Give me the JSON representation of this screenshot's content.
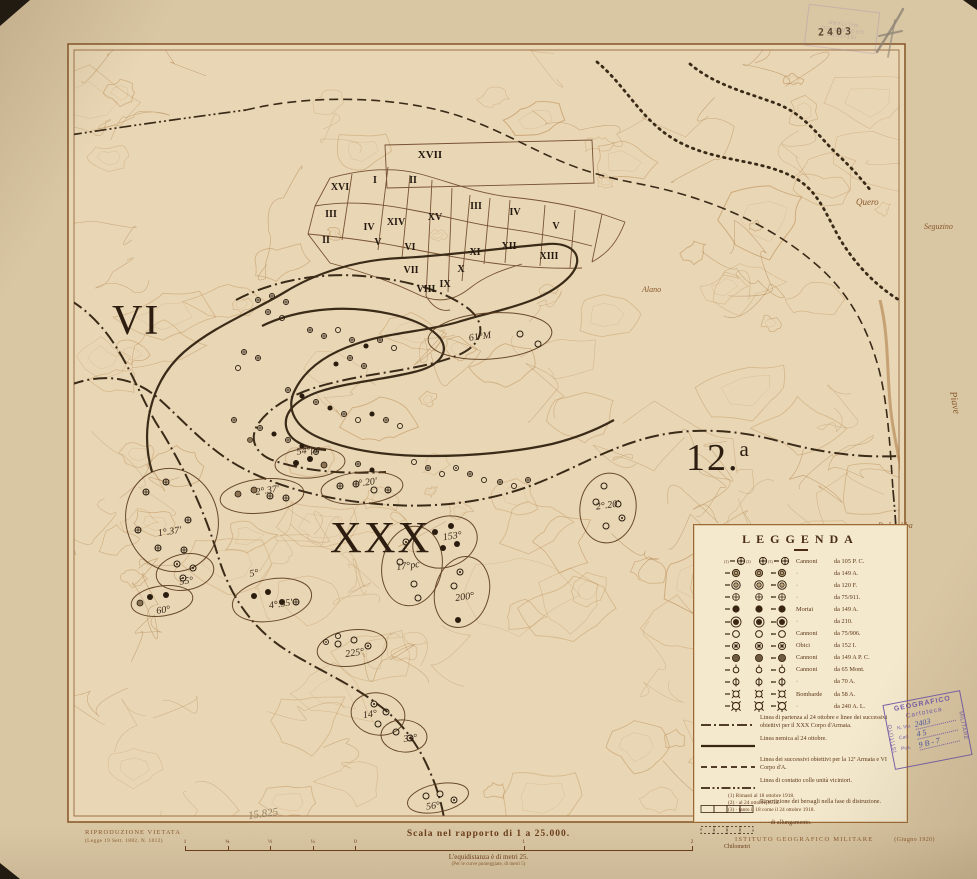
{
  "colors": {
    "paper": "#d9c6a3",
    "map_paper": "#e8d6b4",
    "legend_paper": "#f4e9cd",
    "contour": "#bc8a52",
    "ink": "#8a5a2e",
    "ink_dark": "#3a2a18",
    "symbol_ink": "#2a1d10",
    "stamp_purple": "#6d55a8",
    "handwriting_blue": "#3a49a6",
    "pencil": "#8a8274"
  },
  "legend": {
    "title": "LEGGENDA",
    "symbol_rows": [
      {
        "type": "cross105",
        "numbered": true,
        "name": "Cannoni",
        "cal": "da 105 P. C."
      },
      {
        "type": "shaded",
        "name": "·",
        "cal": "da 149 A."
      },
      {
        "type": "double",
        "name": "·",
        "cal": "da 120 F."
      },
      {
        "type": "plus",
        "name": "·",
        "cal": "da 75/911."
      },
      {
        "type": "filled",
        "name": "Mortai",
        "cal": "da 149 A."
      },
      {
        "type": "filledring",
        "name": "·",
        "cal": "da 210."
      },
      {
        "type": "open",
        "name": "Cannoni",
        "cal": "da 75/906."
      },
      {
        "type": "star",
        "name": "Obici",
        "cal": "da 152 I."
      },
      {
        "type": "gray",
        "name": "Cannoni",
        "cal": "da 149 A P. C."
      },
      {
        "type": "mont",
        "name": "Cannoni",
        "cal": "da 65 Mont."
      },
      {
        "type": "bar",
        "name": "·",
        "cal": "da 70 A."
      },
      {
        "type": "bomb",
        "name": "Bombarde",
        "cal": "da 58 A."
      },
      {
        "type": "bomblg",
        "name": "·",
        "cal": "da 240 A. L."
      }
    ],
    "line_rows": [
      {
        "style": "dashdot",
        "text": "Linea di partenza al 24 ottobre e linee dei successivi obiettivi per il XXX Corpo d'Armata."
      },
      {
        "style": "solid",
        "text": "Linea nemica al 24 ottobre."
      },
      {
        "style": "dashed",
        "text": "Linea dei successivi obiettivi per la 12ª Armata e VI Corpo d'A."
      },
      {
        "style": "contact",
        "text": "Linea di contatto colle unità viciniori."
      },
      {
        "style": "rects",
        "text": "Ripartizione dei bersagli nella fase di distruzione."
      },
      {
        "style": "rectsdot",
        "text": "·      ·      ·      di allungamento."
      }
    ],
    "footnotes": [
      "(1)  Rimasti al 18 ottobre 1918.",
      "(2)    ·    al 24 ottobre 1918.",
      "(3)    ·    tanto il 18 come il 24 ottobre 1918."
    ]
  },
  "margin": {
    "riprod_line1": "RIPRODUZIONE VIETATA",
    "riprod_line2": "(Legge 19 Sett. 1882, N. 1012)",
    "scale_title": "Scala nel rapporto di 1 a 25.000.",
    "equidistanza": "L'equidistanza è di metri 25.",
    "equidistanza_sub": "(Per le curve punteggiate, di metri 5)",
    "igm": "ISTITUTO GEOGRAFICO MILITARE",
    "igm_date": "(Giugno 1920)",
    "pencil_note": "15.825"
  },
  "scale_bar": {
    "unit_label": "Chilometri",
    "ticks": [
      {
        "p": 0.0,
        "label": "1"
      },
      {
        "p": 0.084,
        "label": "¾"
      },
      {
        "p": 0.168,
        "label": "½"
      },
      {
        "p": 0.252,
        "label": "¼"
      },
      {
        "p": 0.336,
        "label": "0"
      },
      {
        "p": 0.668,
        "label": "1"
      },
      {
        "p": 1.0,
        "label": "2"
      }
    ]
  },
  "stamps": {
    "cartoteca": {
      "top": "GEOGRAFICO",
      "left": "ISTITUTO",
      "right": "MILITARE",
      "center": "Cartoteca",
      "rows": [
        {
          "label": "N. Inv.",
          "value": "2403"
        },
        {
          "label": "Cas.",
          "value": "4 5"
        },
        {
          "label": "Pos.",
          "value": "9 B - 7"
        }
      ]
    },
    "top_faint": {
      "line1": "ISTITUTO",
      "line2": "GEOGRAFICO",
      "line3": "MILITARE"
    },
    "inventory_number": "2403"
  },
  "map": {
    "corps_labels": [
      {
        "text": "VI",
        "x": 112,
        "y": 334,
        "size": 42
      },
      {
        "text": "XXX",
        "x": 330,
        "y": 552,
        "size": 44
      },
      {
        "text": "12.",
        "sup": "a",
        "x": 686,
        "y": 470,
        "size": 38
      }
    ],
    "sectors": [
      {
        "label": "XVII",
        "x": 430,
        "y": 158
      },
      {
        "label": "I",
        "x": 375,
        "y": 183
      },
      {
        "label": "II",
        "x": 413,
        "y": 183
      },
      {
        "label": "XVI",
        "x": 340,
        "y": 190
      },
      {
        "label": "III",
        "x": 331,
        "y": 217
      },
      {
        "label": "II",
        "x": 326,
        "y": 243
      },
      {
        "label": "IV",
        "x": 369,
        "y": 230
      },
      {
        "label": "V",
        "x": 378,
        "y": 245
      },
      {
        "label": "XIV",
        "x": 396,
        "y": 225
      },
      {
        "label": "XV",
        "x": 435,
        "y": 220
      },
      {
        "label": "VI",
        "x": 410,
        "y": 250
      },
      {
        "label": "VII",
        "x": 411,
        "y": 273
      },
      {
        "label": "VIII",
        "x": 426,
        "y": 292
      },
      {
        "label": "IX",
        "x": 445,
        "y": 287
      },
      {
        "label": "X",
        "x": 461,
        "y": 272
      },
      {
        "label": "XI",
        "x": 475,
        "y": 255
      },
      {
        "label": "XII",
        "x": 509,
        "y": 249
      },
      {
        "label": "XIII",
        "x": 549,
        "y": 259
      },
      {
        "label": "III",
        "x": 476,
        "y": 209
      },
      {
        "label": "IV",
        "x": 515,
        "y": 215
      },
      {
        "label": "V",
        "x": 556,
        "y": 229
      }
    ],
    "clusters": [
      {
        "label": "1°.37'",
        "lx": -4,
        "ly": 14,
        "cx": 172,
        "cy": 520,
        "rx": 46,
        "ry": 52,
        "rot": -15,
        "syms": [
          [
            "c",
            -26,
            -28
          ],
          [
            "c",
            -6,
            -38
          ],
          [
            "c",
            -34,
            10
          ],
          [
            "c",
            -14,
            28
          ],
          [
            "c",
            12,
            30
          ],
          [
            "c",
            16,
            0
          ]
        ]
      },
      {
        "label": "55°",
        "lx": 0,
        "ly": 12,
        "cx": 185,
        "cy": 572,
        "rx": 29,
        "ry": 18,
        "rot": -10,
        "syms": [
          [
            "d",
            -8,
            -8
          ],
          [
            "d",
            8,
            -4
          ],
          [
            "d",
            -2,
            6
          ]
        ]
      },
      {
        "label": "60°",
        "lx": 0,
        "ly": 12,
        "cx": 162,
        "cy": 601,
        "rx": 31,
        "ry": 15,
        "rot": -8,
        "syms": [
          [
            "f",
            -12,
            -4
          ],
          [
            "f",
            4,
            -6
          ],
          [
            "g",
            -22,
            2
          ]
        ]
      },
      {
        "label": "4°.55'",
        "lx": 8,
        "ly": 8,
        "cx": 272,
        "cy": 600,
        "rx": 40,
        "ry": 21,
        "rot": -10,
        "syms": [
          [
            "f",
            -18,
            -4
          ],
          [
            "f",
            -4,
            -8
          ],
          [
            "f",
            10,
            2
          ],
          [
            "c",
            24,
            2
          ]
        ]
      },
      {
        "label": "5°",
        "lx": 0,
        "ly": -12,
        "cx": 256,
        "cy": 588,
        "rx": 0,
        "ry": 0,
        "rot": 0,
        "syms": []
      },
      {
        "label": "2°.37'",
        "lx": 6,
        "ly": -2,
        "cx": 262,
        "cy": 496,
        "rx": 42,
        "ry": 17,
        "rot": -6,
        "syms": [
          [
            "g",
            -24,
            -2
          ],
          [
            "g",
            -8,
            -6
          ],
          [
            "c",
            8,
            0
          ],
          [
            "c",
            24,
            2
          ]
        ]
      },
      {
        "label": "54°pc",
        "lx": 0,
        "ly": -10,
        "cx": 310,
        "cy": 463,
        "rx": 35,
        "ry": 15,
        "rot": -4,
        "syms": [
          [
            "f",
            -14,
            0
          ],
          [
            "f",
            0,
            -4
          ],
          [
            "g",
            14,
            2
          ]
        ]
      },
      {
        "label": "1°.20'",
        "lx": 4,
        "ly": -2,
        "cx": 362,
        "cy": 488,
        "rx": 41,
        "ry": 16,
        "rot": -5,
        "syms": [
          [
            "c",
            -22,
            -2
          ],
          [
            "c",
            -6,
            -4
          ],
          [
            "o",
            12,
            2
          ],
          [
            "c",
            26,
            2
          ]
        ]
      },
      {
        "label": "17°pc",
        "lx": -4,
        "ly": 2,
        "cx": 412,
        "cy": 566,
        "rx": 30,
        "ry": 40,
        "rot": 10,
        "syms": [
          [
            "d",
            -6,
            -24
          ],
          [
            "o",
            -12,
            -4
          ],
          [
            "o",
            2,
            18
          ],
          [
            "o",
            6,
            32
          ]
        ]
      },
      {
        "label": "153°",
        "lx": 8,
        "ly": -2,
        "cx": 445,
        "cy": 542,
        "rx": 33,
        "ry": 25,
        "rot": -20,
        "syms": [
          [
            "f",
            -10,
            -10
          ],
          [
            "f",
            6,
            -16
          ],
          [
            "f",
            -2,
            6
          ],
          [
            "f",
            12,
            2
          ]
        ]
      },
      {
        "label": "200°",
        "lx": 2,
        "ly": 8,
        "cx": 462,
        "cy": 592,
        "rx": 27,
        "ry": 36,
        "rot": 15,
        "syms": [
          [
            "d",
            -2,
            -20
          ],
          [
            "o",
            -8,
            -6
          ],
          [
            "f",
            -4,
            28
          ]
        ]
      },
      {
        "label": "225°",
        "lx": 2,
        "ly": 8,
        "cx": 352,
        "cy": 648,
        "rx": 35,
        "ry": 18,
        "rot": -8,
        "syms": [
          [
            "o",
            -14,
            -4
          ],
          [
            "o",
            2,
            -8
          ],
          [
            "d",
            16,
            -2
          ]
        ]
      },
      {
        "label": "14°",
        "lx": -8,
        "ly": 2,
        "cx": 378,
        "cy": 714,
        "rx": 27,
        "ry": 21,
        "rot": 10,
        "syms": [
          [
            "d",
            -4,
            -10
          ],
          [
            "o",
            8,
            -2
          ],
          [
            "o",
            0,
            10
          ]
        ]
      },
      {
        "label": "31°",
        "lx": 6,
        "ly": 6,
        "cx": 404,
        "cy": 736,
        "rx": 23,
        "ry": 16,
        "rot": 5,
        "syms": [
          [
            "o",
            -8,
            -4
          ],
          [
            "d",
            6,
            2
          ]
        ]
      },
      {
        "label": "56°",
        "lx": -6,
        "ly": 10,
        "cx": 438,
        "cy": 798,
        "rx": 31,
        "ry": 14,
        "rot": -12,
        "syms": [
          [
            "o",
            -12,
            -2
          ],
          [
            "o",
            2,
            -4
          ],
          [
            "d",
            16,
            2
          ]
        ]
      },
      {
        "label": "2°.20'",
        "lx": 0,
        "ly": 0,
        "cx": 608,
        "cy": 508,
        "rx": 28,
        "ry": 35,
        "rot": 8,
        "syms": [
          [
            "o",
            -4,
            -22
          ],
          [
            "o",
            -12,
            -6
          ],
          [
            "o",
            10,
            -4
          ],
          [
            "o",
            -2,
            18
          ],
          [
            "d",
            14,
            10
          ]
        ]
      },
      {
        "label": "61°M",
        "lx": -10,
        "ly": 2,
        "cx": 490,
        "cy": 336,
        "rx": 62,
        "ry": 23,
        "rot": -4,
        "syms": [
          [
            "o",
            30,
            -2
          ],
          [
            "o",
            48,
            8
          ]
        ]
      }
    ],
    "loose_symbols": [
      [
        258,
        300,
        "c"
      ],
      [
        272,
        296,
        "c"
      ],
      [
        286,
        302,
        "c"
      ],
      [
        268,
        312,
        "c"
      ],
      [
        282,
        318,
        "o"
      ],
      [
        244,
        352,
        "c"
      ],
      [
        258,
        358,
        "c"
      ],
      [
        238,
        368,
        "o"
      ],
      [
        310,
        330,
        "c"
      ],
      [
        324,
        336,
        "c"
      ],
      [
        338,
        330,
        "o"
      ],
      [
        352,
        340,
        "c"
      ],
      [
        366,
        346,
        "f"
      ],
      [
        380,
        340,
        "c"
      ],
      [
        394,
        348,
        "o"
      ],
      [
        350,
        358,
        "c"
      ],
      [
        336,
        364,
        "f"
      ],
      [
        364,
        366,
        "c"
      ],
      [
        288,
        390,
        "c"
      ],
      [
        302,
        396,
        "f"
      ],
      [
        316,
        402,
        "c"
      ],
      [
        330,
        408,
        "f"
      ],
      [
        344,
        414,
        "c"
      ],
      [
        358,
        420,
        "o"
      ],
      [
        372,
        414,
        "f"
      ],
      [
        386,
        420,
        "c"
      ],
      [
        400,
        426,
        "o"
      ],
      [
        260,
        428,
        "c"
      ],
      [
        274,
        434,
        "f"
      ],
      [
        288,
        440,
        "c"
      ],
      [
        302,
        446,
        "f"
      ],
      [
        316,
        452,
        "c"
      ],
      [
        414,
        462,
        "o"
      ],
      [
        428,
        468,
        "c"
      ],
      [
        442,
        474,
        "o"
      ],
      [
        456,
        468,
        "d"
      ],
      [
        470,
        474,
        "c"
      ],
      [
        484,
        480,
        "o"
      ],
      [
        372,
        470,
        "f"
      ],
      [
        358,
        464,
        "c"
      ],
      [
        250,
        440,
        "g"
      ],
      [
        234,
        420,
        "c"
      ],
      [
        500,
        482,
        "c"
      ],
      [
        514,
        486,
        "o"
      ],
      [
        528,
        480,
        "c"
      ],
      [
        338,
        636,
        "o"
      ],
      [
        326,
        642,
        "d"
      ]
    ],
    "lines": [
      {
        "name": "railway-dotted-1",
        "style": "dotted",
        "d": "M597,62 C625,85 640,118 672,138 C712,163 760,158 795,178 C822,193 828,222 845,247 C862,272 880,288 899,300"
      },
      {
        "name": "railway-dotted-2",
        "style": "dotted",
        "d": "M690,64 C715,85 745,92 775,103 C805,114 818,136 838,155 C852,168 862,180 872,192"
      },
      {
        "name": "objectives-dashed-arc",
        "style": "dashed",
        "d": "M246,110 C320,92 410,98 465,118 C530,142 555,168 635,183 C715,198 775,228 818,266 C850,294 868,330 878,366 C888,402 890,448 893,490"
      },
      {
        "name": "contact-top-left",
        "style": "contact",
        "d": "M70,135 C128,126 186,118 246,110"
      },
      {
        "name": "contact-right-edge",
        "style": "contact",
        "d": "M893,490 C896,522 898,556 898,592"
      },
      {
        "name": "partenza-left-edge",
        "style": "dashdot",
        "d": "M70,300 C95,315 112,338 125,362 C138,386 148,412 162,432"
      },
      {
        "name": "partenza-main",
        "style": "dashdot",
        "d": "M70,385 C105,372 135,378 158,398 C185,422 210,452 246,470 C290,492 340,502 392,505 C444,508 492,500 530,486 C570,471 600,452 640,440 C690,425 740,430 782,442 C822,453 862,458 900,456"
      },
      {
        "name": "partenza-south",
        "style": "dashdot",
        "d": "M162,432 C185,470 205,512 218,556 C230,596 252,628 286,650 C318,670 352,684 380,706 C404,724 420,748 430,772 C438,790 442,806 444,818"
      },
      {
        "name": "enemy-line",
        "style": "solid",
        "d": "M152,472 C140,430 150,382 184,352 C214,326 252,312 285,292 C316,273 356,260 400,258 C446,256 500,248 548,244 C574,242 586,258 570,276 C544,304 496,310 458,322 C424,332 390,332 356,344 C326,354 304,370 294,392 C286,410 296,428 320,438 C352,452 392,456 432,456 C472,456 516,452 552,444 C576,438 596,430 614,420"
      },
      {
        "name": "objective-loop-1",
        "style": "dashdot",
        "d": "M236,300 C270,282 318,272 362,276 C410,280 448,292 470,310 C488,326 482,346 456,356 C420,370 376,372 336,382 C300,390 272,404 258,424 C248,440 256,456 278,462 C310,472 348,474 386,472"
      },
      {
        "name": "objective-loop-2",
        "style": "solid",
        "d": "M262,326 C290,312 330,306 366,310 C402,314 428,324 440,338 C450,352 440,366 414,372 C382,380 348,382 318,392 C296,400 284,412 286,426 C288,440 304,448 326,450"
      },
      {
        "name": "river-piave",
        "style": "river",
        "d": "M880,300 C890,340 886,380 892,420 C898,460 908,500 916,540 C922,570 930,600 936,626"
      }
    ],
    "place_names": [
      {
        "text": "Quero",
        "x": 856,
        "y": 205,
        "size": 9,
        "rot": 0
      },
      {
        "text": "Seguzino",
        "x": 924,
        "y": 229,
        "size": 8,
        "rot": 0
      },
      {
        "text": "Pederobba",
        "x": 878,
        "y": 528,
        "size": 8,
        "rot": 0
      },
      {
        "text": "Alano",
        "x": 642,
        "y": 292,
        "size": 8,
        "rot": 0
      },
      {
        "text": "Piave",
        "x": 950,
        "y": 392,
        "size": 10,
        "rot": 80
      }
    ]
  }
}
